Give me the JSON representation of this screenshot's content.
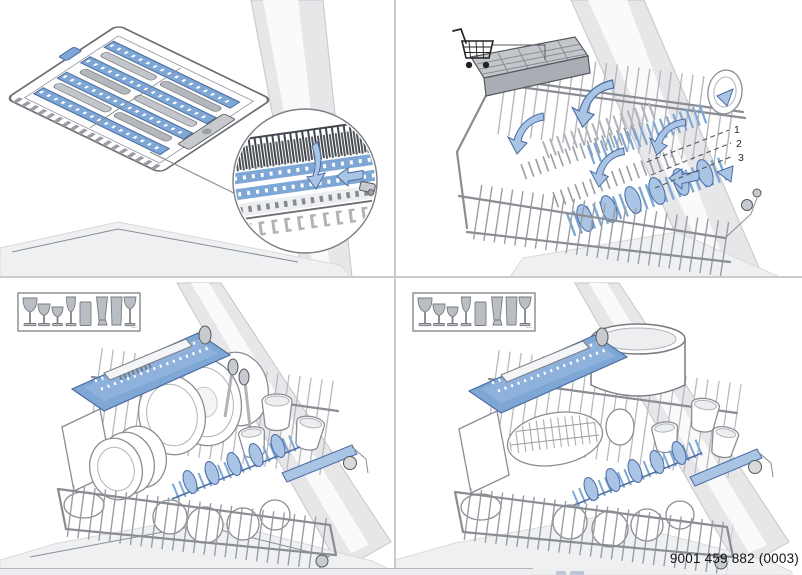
{
  "colors": {
    "accent_blue": "#7fa7d6",
    "accent_blue_dark": "#4a6ca0",
    "accent_blue_light": "#a9c4e4",
    "outline_dark": "#54575d",
    "outline_mid": "#8a8d93",
    "wall_gray": "#e7e7ea",
    "wall_gray_edge": "#c6c6ca",
    "floor_gray": "#eef0f1",
    "metal_gray": "#c7cace",
    "glass_fill": "#b9bec5",
    "glass_stroke": "#787b80",
    "divider_gray": "#cbcbcd",
    "footer_bar": "#ececee",
    "footer_bar_border": "#b5b5b9",
    "text": "#111111"
  },
  "top_right_panel": {
    "level_labels": [
      "1",
      "2",
      "3"
    ],
    "icons": [
      "shopping-cart-icon",
      "fold-arrow-icon",
      "adjust-up-arrow-icon",
      "adjust-down-arrow-icon"
    ]
  },
  "top_left_panel": {
    "icons": [
      "detail-callout-circle",
      "fold-down-arrow-icon",
      "slide-left-arrow-icon"
    ]
  },
  "glass_legend": {
    "glasses": [
      "tall-wine-glass-icon",
      "wine-glass-icon",
      "small-wine-glass-icon",
      "champagne-flute-icon",
      "tumbler-icon",
      "pilsner-glass-icon",
      "longdrink-glass-icon",
      "beer-tulip-glass-icon"
    ],
    "more_label": "..."
  },
  "footer": {
    "part_number": "9001 459 882 (0003)"
  }
}
